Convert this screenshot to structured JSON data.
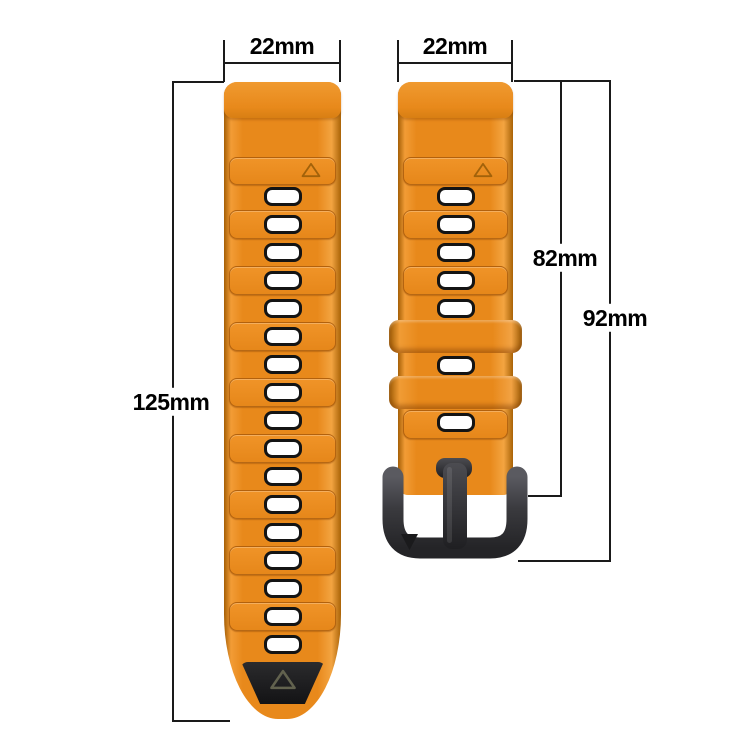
{
  "title": "watch-strap-dimension-diagram",
  "labels": {
    "left_width": "22mm",
    "right_width": "22mm",
    "left_length": "125mm",
    "right_inner_length": "82mm",
    "right_outer_length": "92mm"
  },
  "colors": {
    "background": "#ffffff",
    "strap_orange": "#e8891b",
    "strap_orange_light": "#f3a441",
    "strap_orange_dark": "#a55f06",
    "hole_fill": "#ffffff",
    "hole_border": "#141414",
    "tip_black": "#1b1b1d",
    "buckle_dark": "#3a3a3e",
    "dimension_line": "#1a1a1a",
    "label_text": "#000000"
  },
  "icons": {
    "strap_triangle_marker": "triangle-up-outline",
    "tip_triangle_marker": "triangle-up-outline",
    "buckle_triangle_marker": "triangle-down-filled"
  },
  "diagram": {
    "label_positions": {
      "left_width": {
        "cx": 282,
        "cy": 46
      },
      "right_width": {
        "cx": 455,
        "cy": 46
      },
      "left_length": {
        "cx": 171,
        "cy": 402
      },
      "right_inner_length": {
        "cx": 565,
        "cy": 258
      },
      "right_outer_length": {
        "cx": 615,
        "cy": 318
      }
    },
    "dimension_lines": [
      {
        "name": "left-width-line",
        "x": 224,
        "y": 62,
        "w": 117,
        "h": 2
      },
      {
        "name": "left-width-tick-l",
        "x": 223,
        "y": 40,
        "w": 2,
        "h": 42
      },
      {
        "name": "left-width-tick-r",
        "x": 339,
        "y": 40,
        "w": 2,
        "h": 42
      },
      {
        "name": "right-width-line",
        "x": 398,
        "y": 62,
        "w": 115,
        "h": 2
      },
      {
        "name": "right-width-tick-l",
        "x": 397,
        "y": 40,
        "w": 2,
        "h": 42
      },
      {
        "name": "right-width-tick-r",
        "x": 511,
        "y": 40,
        "w": 2,
        "h": 42
      },
      {
        "name": "left-length-top-tick",
        "x": 172,
        "y": 81,
        "w": 52,
        "h": 2
      },
      {
        "name": "left-length-line",
        "x": 172,
        "y": 81,
        "w": 2,
        "h": 641
      },
      {
        "name": "left-length-bot-tick",
        "x": 172,
        "y": 720,
        "w": 58,
        "h": 2
      },
      {
        "name": "right-top-connector",
        "x": 514,
        "y": 80,
        "w": 97,
        "h": 2
      },
      {
        "name": "inner-length-line",
        "x": 560,
        "y": 80,
        "w": 2,
        "h": 417
      },
      {
        "name": "inner-length-bot-tick",
        "x": 528,
        "y": 495,
        "w": 34,
        "h": 2
      },
      {
        "name": "outer-length-line",
        "x": 609,
        "y": 80,
        "w": 2,
        "h": 482
      },
      {
        "name": "outer-length-bot-tick",
        "x": 518,
        "y": 560,
        "w": 93,
        "h": 2
      }
    ],
    "straps": {
      "left": {
        "x": 224,
        "y": 82,
        "w": 117,
        "h": 637,
        "radius": "13px 13px 54px 54px / 13px 13px 105px 105px",
        "lug_h": 36,
        "triangle_segment": {
          "top": 75,
          "h": 26
        },
        "segments": [
          128,
          184,
          240,
          296,
          352,
          408,
          464,
          520
        ],
        "segment_h": 27,
        "holes": [
          114,
          142,
          170,
          198,
          226,
          254,
          282,
          310,
          338,
          366,
          394,
          422,
          450,
          478,
          506,
          534,
          562
        ],
        "tip": {
          "top": 580,
          "w": 86,
          "h": 42
        }
      },
      "right": {
        "x": 398,
        "y": 82,
        "w": 115,
        "h": 413,
        "radius": "13px 13px 10px 10px",
        "lug_h": 36,
        "triangle_segment": {
          "top": 75,
          "h": 26
        },
        "segments": [
          128,
          184,
          328
        ],
        "segment_h": 27,
        "holes": [
          114,
          142,
          170,
          198,
          226,
          283,
          340
        ],
        "tip": null
      }
    },
    "keepers": [
      {
        "x": 389,
        "y": 320,
        "w": 133,
        "h": 33
      },
      {
        "x": 389,
        "y": 376,
        "w": 133,
        "h": 33
      }
    ],
    "buckle": {
      "x": 380,
      "y": 455,
      "w": 152,
      "h": 112
    }
  }
}
